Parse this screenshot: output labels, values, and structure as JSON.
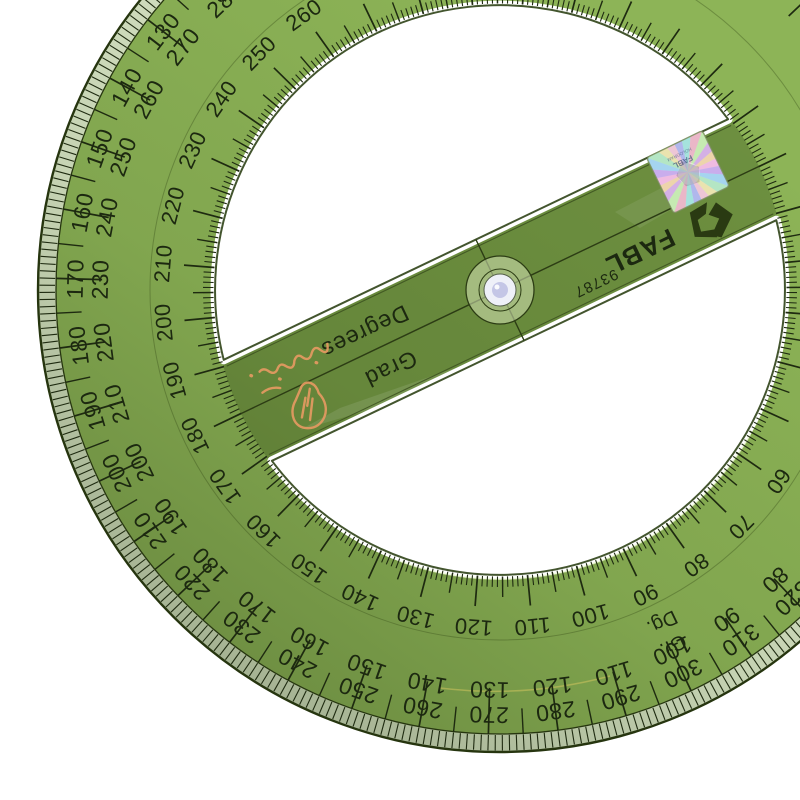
{
  "scene": {
    "description": "Transparent green 360-degree circular protractor (angle finder with rotating arm and center pivot hole) photographed on a white background, rotated about 25 degrees, bottom-left of circle cropped"
  },
  "brand": {
    "name": "FABL",
    "serial": "93787",
    "hologram_line1": "FABL",
    "hologram_line2": "HOLOGRAM"
  },
  "arm": {
    "scale_words": {
      "degrees": "Degrees",
      "grad": "Grad"
    }
  },
  "ring": {
    "abbr": {
      "grad": "Gr.",
      "degrees": "Dg."
    },
    "degree_scale": {
      "unit": "degrees",
      "full_circle": 360,
      "tick_step": 1,
      "label_step": 10,
      "direction": "clockwise from arm axis",
      "visible_labels": [
        60,
        70,
        80,
        90,
        100,
        110,
        120,
        130,
        140,
        150,
        160,
        170,
        180,
        190,
        200,
        210,
        220,
        230,
        240,
        250,
        260,
        270
      ]
    },
    "grad_scale": {
      "unit": "grads",
      "full_circle": 400,
      "tick_step": 1,
      "label_step": 10,
      "direction": "counterclockwise from arm axis, paired with complement (sum 400)",
      "visible_pairs": [
        [
          120,
          280
        ],
        [
          130,
          270
        ],
        [
          140,
          260
        ],
        [
          150,
          250
        ],
        [
          160,
          240
        ],
        [
          170,
          230
        ],
        [
          180,
          220
        ],
        [
          190,
          210
        ],
        [
          200,
          200
        ],
        [
          210,
          190
        ],
        [
          220,
          180
        ],
        [
          230,
          170
        ],
        [
          240,
          160
        ],
        [
          250,
          150
        ],
        [
          260,
          140
        ],
        [
          270,
          130
        ],
        [
          280,
          120
        ],
        [
          290,
          110
        ],
        [
          300,
          100
        ],
        [
          310,
          90
        ],
        [
          320,
          80
        ]
      ]
    }
  },
  "watermark": {
    "label": "orange hand-holding-pencil logo with script text"
  },
  "colors": {
    "body": "#8db457",
    "rim_band": "#d9e6c6",
    "edge_line": "#26350f",
    "tick": "#1e2a10",
    "text": "#1c2810",
    "bar_tint": "rgba(58,84,26,0.38)",
    "window": "#ffffff",
    "hole_white": "#eef0f8",
    "hole_center": "#c4c6e6",
    "recess": "rgba(213,228,182,0.55)",
    "shade_dark": "rgba(25,40,8,0.30)",
    "watermark": "#e59a62",
    "hologram": [
      "#f2b8e0",
      "#c8a8ec",
      "#a0d4f0",
      "#b0e8c0",
      "#ece4a8",
      "#f0c4d4",
      "#acb4ec",
      "#a0e4dc",
      "#ecb4c4",
      "#c4ecac",
      "#d4ace4",
      "#f0d4a4"
    ]
  }
}
